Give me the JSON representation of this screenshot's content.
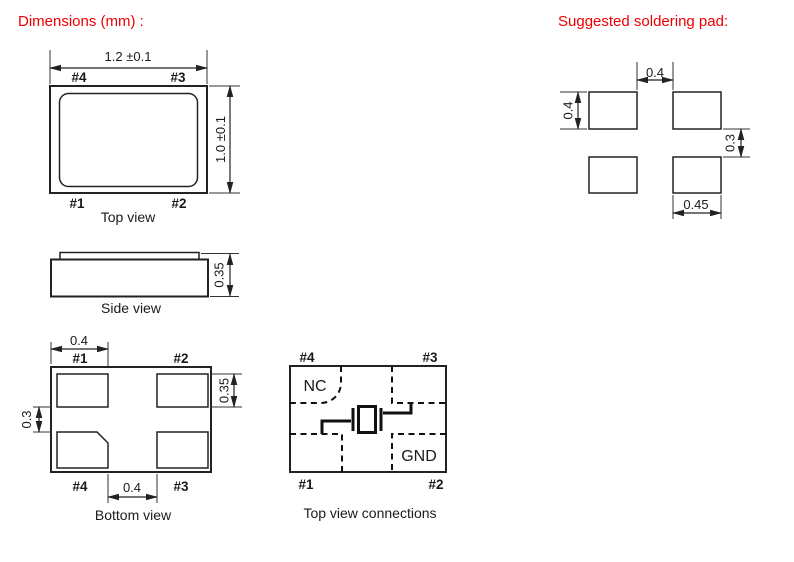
{
  "titles": {
    "dimensions": "Dimensions (mm) :",
    "soldering_pad": "Suggested soldering pad:"
  },
  "colors": {
    "title_red": "#ee0000",
    "line": "#222222",
    "background": "#ffffff"
  },
  "top_view": {
    "caption": "Top view",
    "dim_width": "1.2 ±0.1",
    "dim_height": "1.0 ±0.1",
    "pin_top_left": "#4",
    "pin_top_right": "#3",
    "pin_bottom_left": "#1",
    "pin_bottom_right": "#2"
  },
  "side_view": {
    "caption": "Side view",
    "dim_height": "0.35"
  },
  "bottom_view": {
    "caption": "Bottom view",
    "dim_pad_width": "0.4",
    "dim_pad_height": "0.35",
    "dim_pad_gap_vertical": "0.3",
    "dim_pad_gap_horizontal": "0.4",
    "pin_top_left": "#1",
    "pin_top_right": "#2",
    "pin_bottom_left": "#4",
    "pin_bottom_right": "#3"
  },
  "connections": {
    "caption": "Top view connections",
    "label_nc": "NC",
    "label_gnd": "GND",
    "pin_top_left": "#4",
    "pin_top_right": "#3",
    "pin_bottom_left": "#1",
    "pin_bottom_right": "#2"
  },
  "soldering_pad": {
    "dim_gap_horizontal": "0.4",
    "dim_pad_height": "0.4",
    "dim_gap_vertical": "0.3",
    "dim_pad_width": "0.45"
  }
}
